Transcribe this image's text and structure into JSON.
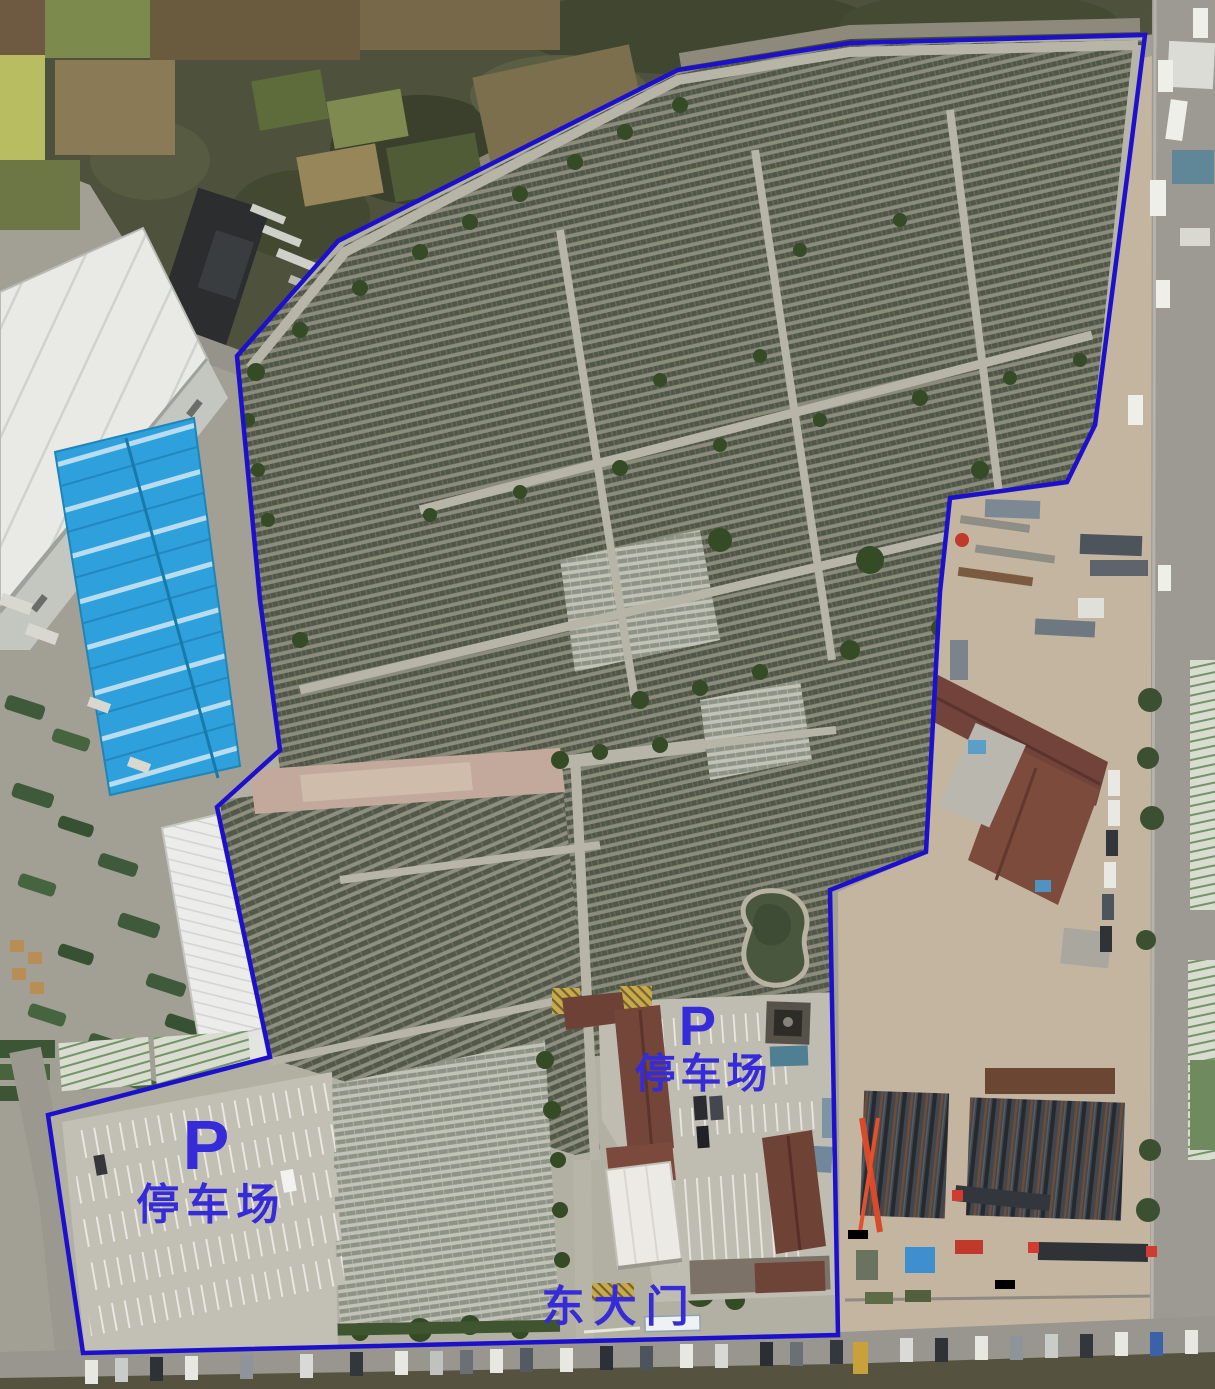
{
  "image": {
    "kind": "aerial-drone-photo",
    "width": 1215,
    "height": 1389,
    "scene": "Cemetery site with blue survey boundary, two parking lots and east gate annotations"
  },
  "annotations": {
    "boundary_color": "#1c10cd",
    "label_color": "#362bd8",
    "boundary_points": "237,356 338,241 678,70 850,43 1145,35 1128,170 1095,425 1067,482 950,498 940,592 926,852 830,890 838,1335 83,1353 48,1115 270,1057 217,807 280,750 260,600",
    "labels": {
      "parking_west": {
        "symbol": "P",
        "name": "停车场"
      },
      "parking_center": {
        "symbol": "P",
        "name": "停车场"
      },
      "east_gate": {
        "name": "东大门"
      }
    }
  }
}
